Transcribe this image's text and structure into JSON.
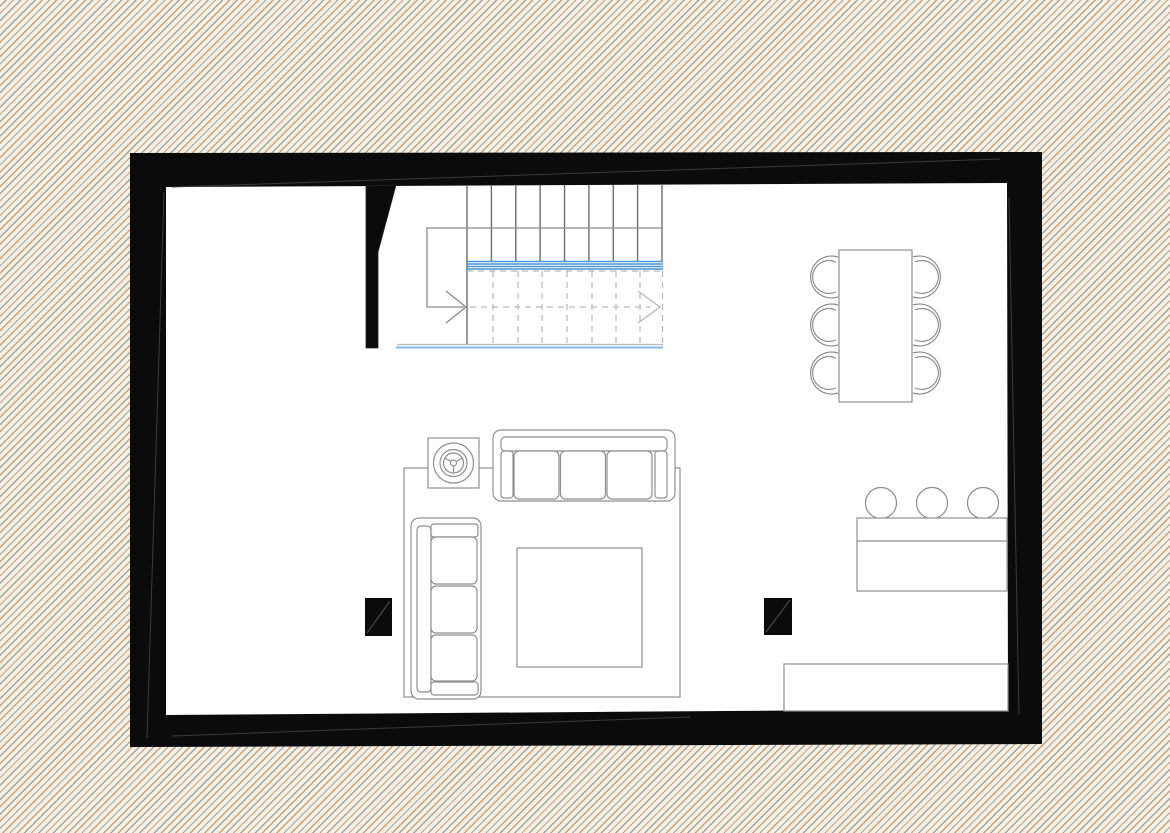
{
  "document": {
    "type": "architectural-floor-plan",
    "title": "Floor plan — open living level",
    "visible_text": "none"
  },
  "colors": {
    "hatch_cream": "#f5f0e6",
    "hatch_gray": "#a9a195",
    "hatch_tan": "#c9a07e",
    "wall_black": "#0b0b0b",
    "wall_seam": "#3a3a3a",
    "paper_white": "#ffffff",
    "line_gray": "#8f8f8f",
    "tread_gray": "#6e6e6e",
    "walk_gray": "#8a8a8a",
    "dash_gray": "#b8b8b8",
    "stair_blue": "#4a94d8",
    "stair_blue_light": "#8fbce8"
  },
  "plan": {
    "canvas": {
      "label": "floor plan drawing",
      "width_px": 1170,
      "height_px": 833
    },
    "walls": {
      "label": "exterior walls (solid poché)",
      "thickness_px": 35
    },
    "partition": {
      "label": "stair partition wall"
    },
    "staircase": {
      "label": "straight staircase with break line",
      "upper_flight_tread_lines": 9,
      "lower_flight_tread_lines_dashed": 7,
      "direction": "up to the right (solid and dashed walk-line arrows)",
      "break_line_color": "#4a94d8"
    },
    "dining": {
      "table": {
        "label": "rectangular dining table"
      },
      "chair_count": 6,
      "chairs_per_side": 3
    },
    "living": {
      "rug": {
        "label": "square area rug"
      },
      "sofa_top": {
        "label": "three-seat sofa, facing down",
        "seats": 3
      },
      "sofa_left": {
        "label": "three-seat sofa, facing right",
        "seats": 3
      },
      "coffee_table": {
        "label": "square coffee table"
      },
      "plant": {
        "label": "potted plant on square stand"
      }
    },
    "kitchen": {
      "bar_counter": {
        "label": "bar counter with worktop line"
      },
      "bar_stool_count": 3,
      "bottom_counter": {
        "label": "kitchen counter along bottom wall"
      }
    },
    "columns": {
      "label": "structural column (filled)",
      "count": 2
    }
  }
}
